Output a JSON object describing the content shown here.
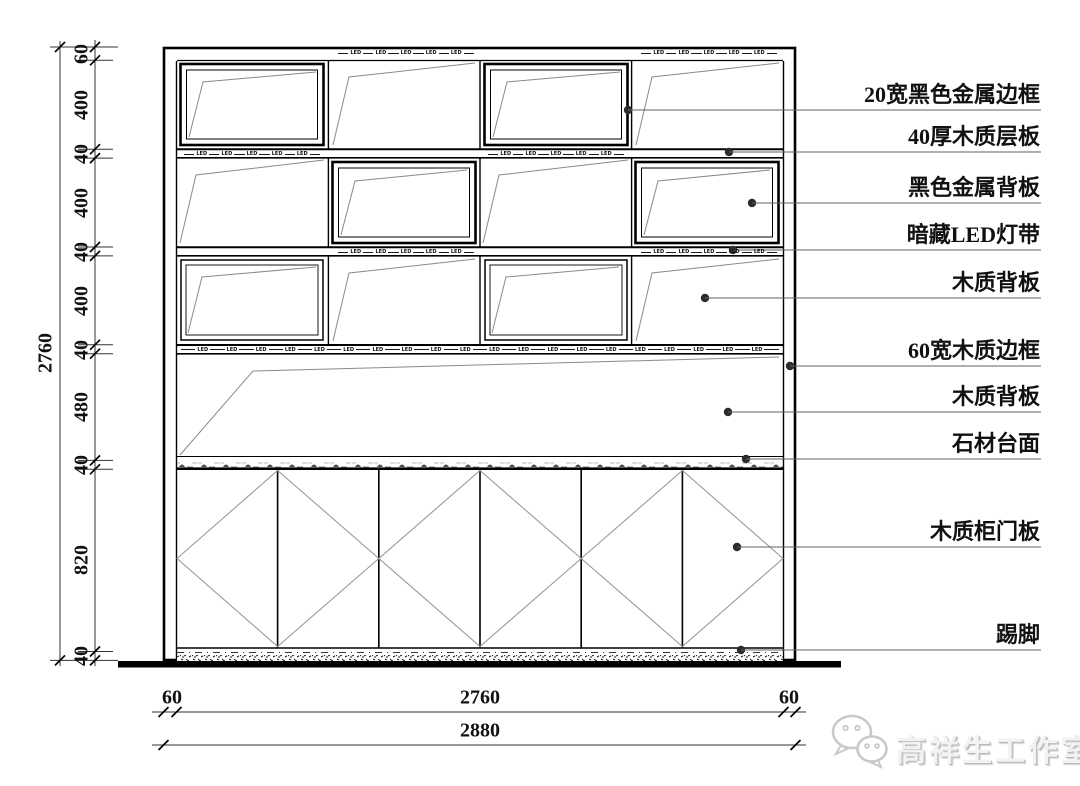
{
  "drawing": {
    "type": "cabinet-elevation",
    "line_color": "#000000",
    "background": "#ffffff"
  },
  "led": {
    "label": "LED"
  },
  "callouts": [
    {
      "text": "20宽黑色金属边框"
    },
    {
      "text": "40厚木质层板"
    },
    {
      "text": "黑色金属背板"
    },
    {
      "text": "暗藏LED灯带"
    },
    {
      "text": "木质背板"
    },
    {
      "text": "60宽木质边框"
    },
    {
      "text": "木质背板"
    },
    {
      "text": "石材台面"
    },
    {
      "text": "木质柜门板"
    },
    {
      "text": "踢脚"
    }
  ],
  "dimensions": {
    "left": {
      "total": "2760",
      "segments": [
        "60",
        "400",
        "40",
        "400",
        "40",
        "400",
        "40",
        "480",
        "40",
        "820",
        "40"
      ]
    },
    "bottom": {
      "inner": [
        "60",
        "2760",
        "60"
      ],
      "overall": "2880"
    }
  },
  "watermark": {
    "text": "高祥生工作室",
    "icon": "wechat-bubbles-icon",
    "color": "#c9c9c9"
  }
}
